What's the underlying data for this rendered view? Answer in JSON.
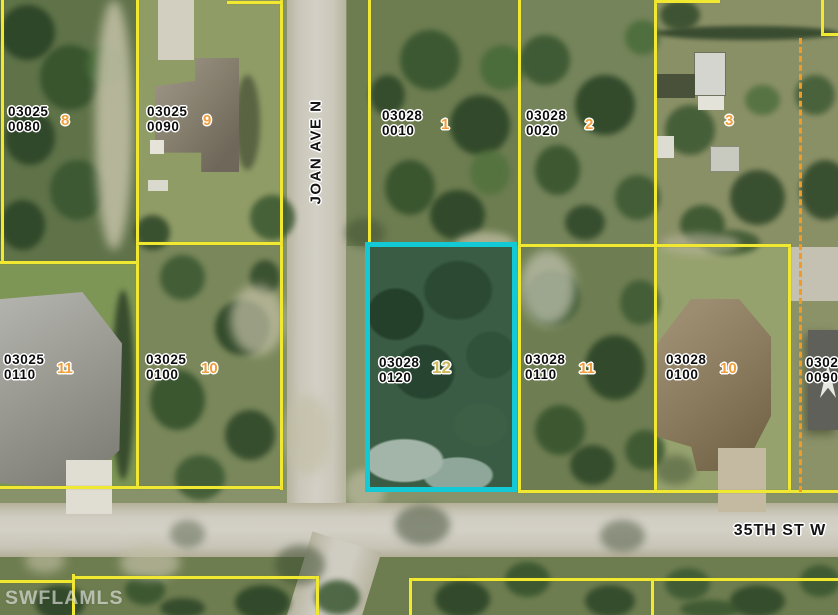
{
  "map": {
    "watermark": "SWFLAMLS",
    "streets": {
      "vertical": "JOAN AVE N",
      "horizontal": "35TH ST W"
    },
    "colors": {
      "parcel_line": "#f1e832",
      "highlight_border": "#14c9d6",
      "lot_number": "#f09f3c",
      "highlight_lot_number": "#cdb95e",
      "dashed_boundary": "#ee9b28",
      "label_text": "#0c0c0c"
    },
    "parcels": [
      {
        "id1": "03025",
        "id2": "0080",
        "lot": "8"
      },
      {
        "id1": "03025",
        "id2": "0090",
        "lot": "9"
      },
      {
        "id1": "03028",
        "id2": "0010",
        "lot": "1"
      },
      {
        "id1": "03028",
        "id2": "0020",
        "lot": "2"
      },
      {
        "id1": "",
        "id2": "",
        "lot": "3"
      },
      {
        "id1": "03025",
        "id2": "0110",
        "lot": "11"
      },
      {
        "id1": "03025",
        "id2": "0100",
        "lot": "10"
      },
      {
        "id1": "03028",
        "id2": "0120",
        "lot": "12",
        "highlighted": true
      },
      {
        "id1": "03028",
        "id2": "0110",
        "lot": "11"
      },
      {
        "id1": "03028",
        "id2": "0100",
        "lot": "10"
      },
      {
        "id1": "03028",
        "id2": "0090",
        "lot": "",
        "clipped_at_edge": true
      }
    ]
  }
}
